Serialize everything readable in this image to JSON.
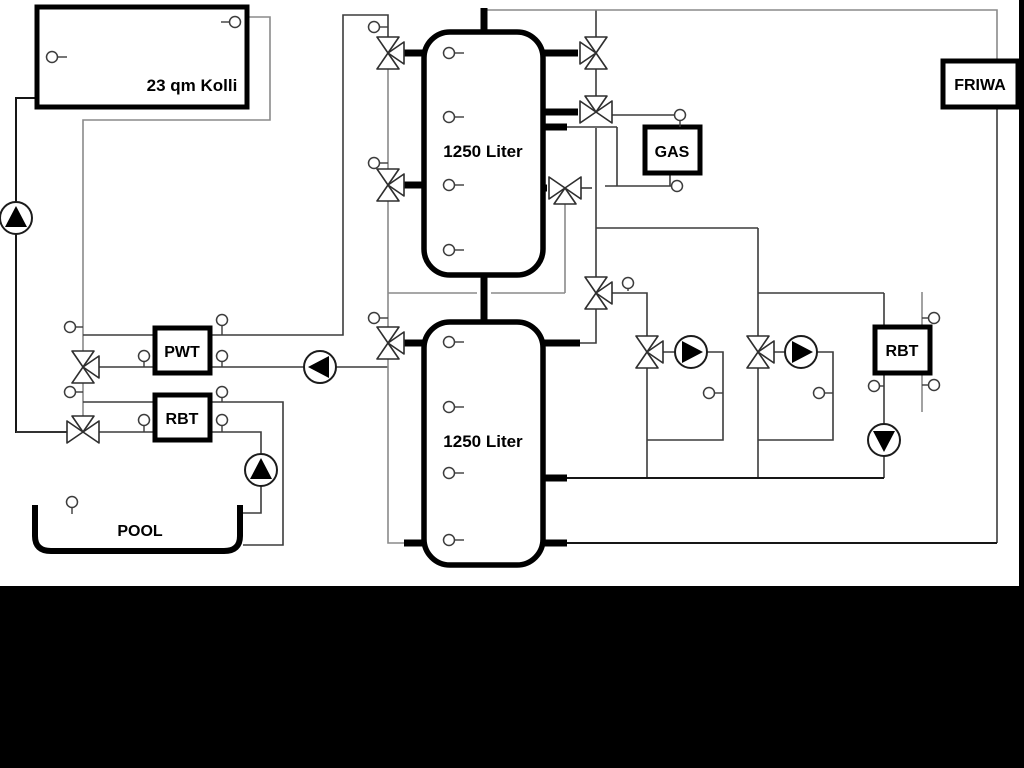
{
  "labels": {
    "collector": "23 qm Kolli",
    "tank_top": "1250 Liter",
    "tank_bottom": "1250 Liter",
    "pwt": "PWT",
    "rbt_left": "RBT",
    "gas": "GAS",
    "friwa": "FRIWA",
    "rbt_right": "RBT",
    "pool": "POOL"
  },
  "colors": {
    "background": "#ffffff",
    "frame_black": "#000000",
    "pipe_gray": "#8a8a8a",
    "pipe_dark": "#3c3c3c"
  }
}
